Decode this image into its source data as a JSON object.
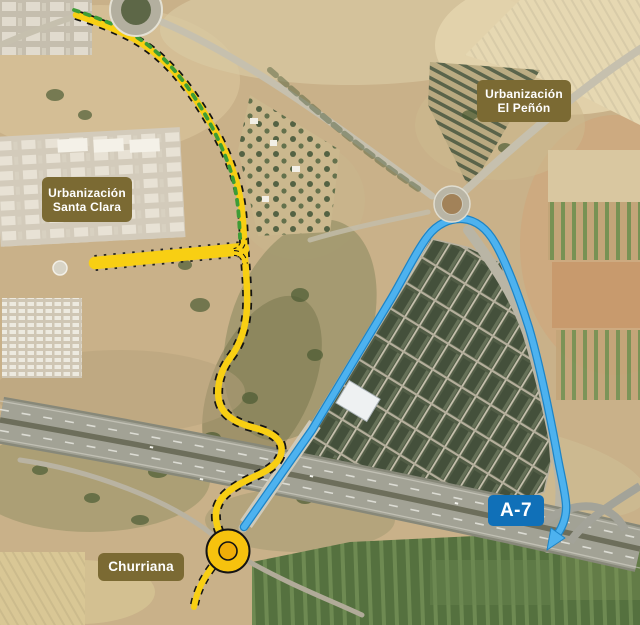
{
  "map": {
    "region_labels": {
      "santa_clara": {
        "line1": "Urbanización",
        "line2": "Santa Clara"
      },
      "el_penon": {
        "line1": "Urbanización",
        "line2": "El Peñón"
      },
      "churriana": {
        "text": "Churriana"
      }
    },
    "road_labels": {
      "a7": {
        "text": "A-7"
      }
    },
    "colors": {
      "label_bg": "#7b6a33",
      "label_text": "#ffffff",
      "a7_label_bg": "#1070b8",
      "a7_label_text": "#ffffff",
      "planned_road_yellow": "#f8cf13",
      "planned_road_casing": "#141414",
      "route_blue": "#4db2ef",
      "route_blue_edge": "#1d84c6",
      "green_dashes": "#3d9c36",
      "churriana_roundabout_fill": "#f6c20e"
    },
    "features": {
      "roundabouts": [
        "north-roundabout",
        "el-penon-roundabout",
        "churriana-roundabout"
      ],
      "routes": [
        {
          "name": "planned-yellow-road",
          "style": "yellow with dashed black casing, branch to Santa Clara"
        },
        {
          "name": "blue-a7-access-route",
          "style": "blue line ending in arrow at A-7"
        }
      ]
    }
  }
}
